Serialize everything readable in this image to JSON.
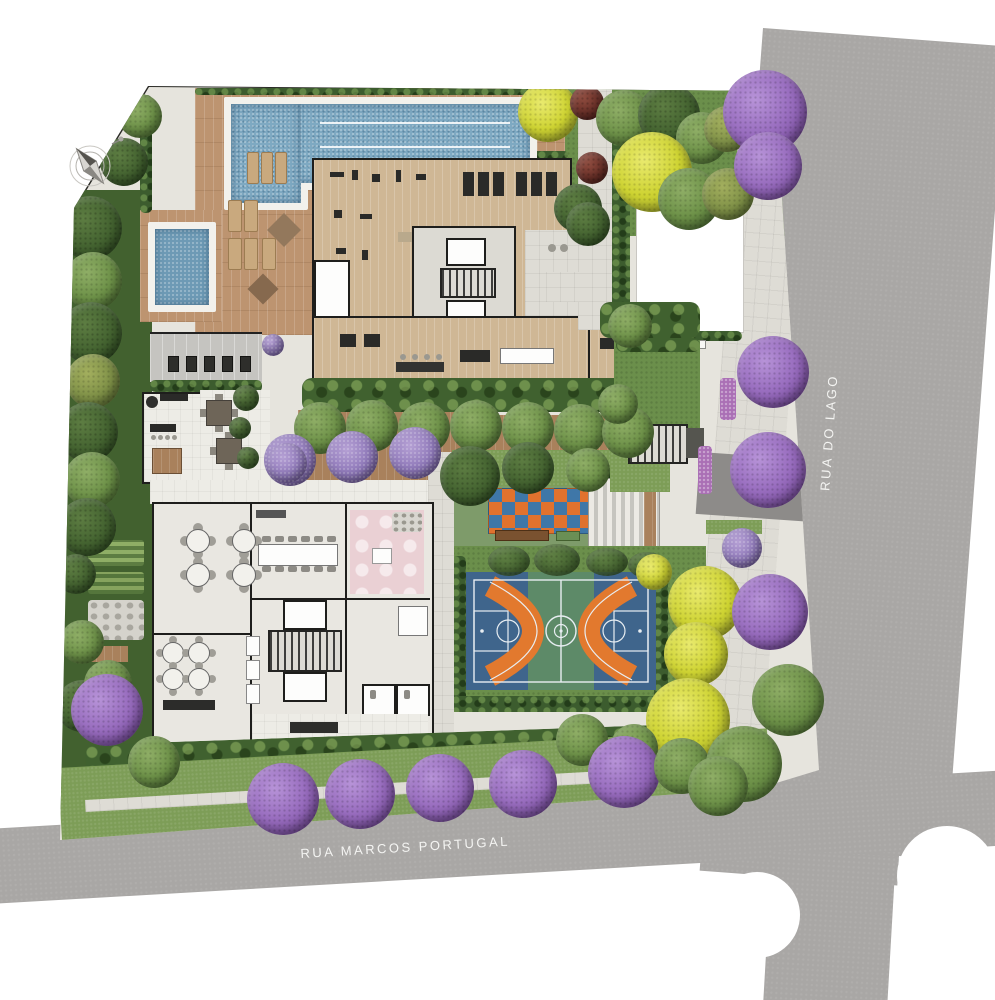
{
  "streets": {
    "bottom_label": "RUA MARCOS PORTUGAL",
    "right_label": "RUA DO LAGO"
  },
  "compass": {
    "icon": "north-arrow-icon"
  },
  "palette": {
    "road": "#a9a7a5",
    "lawn": "#7d9d57",
    "hedge": "#3c5c2e",
    "wood_deck": "#bd9470",
    "pool_water": "#7ea9c2",
    "court_blue": "#3f658c",
    "court_green": "#5d8a68",
    "court_orange": "#e2792e",
    "checker_orange": "#e0722e",
    "checker_blue": "#3f77a8",
    "tree_purple": "#9a6fc0",
    "tree_yellow": "#ced332",
    "kids_room_pink": "#ead0d4",
    "building_wall": "#1e1e1c",
    "floor_light": "#e9e7e1"
  }
}
